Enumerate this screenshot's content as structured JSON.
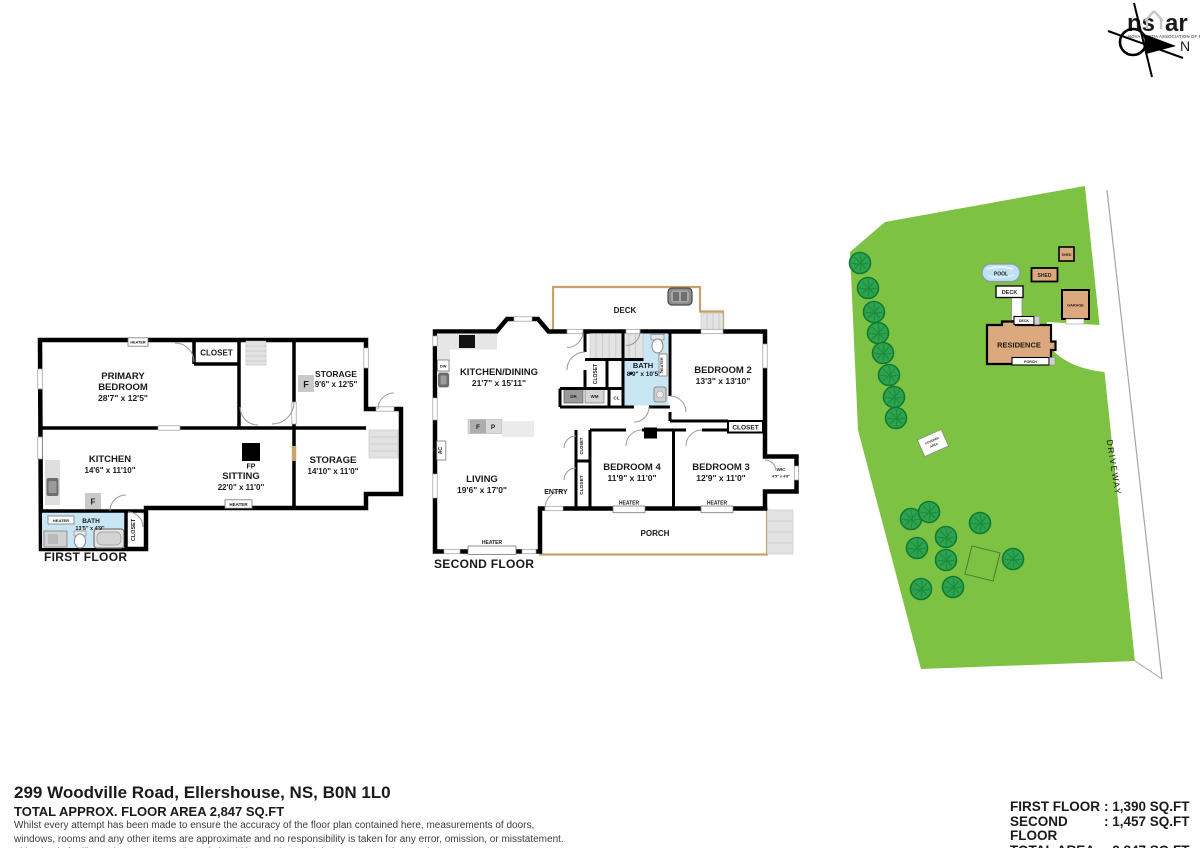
{
  "branding": {
    "logo_ns": "ns",
    "logo_ar": "ar",
    "logo_sub": "NOVA SCOTIA ASSOCIATION OF REALTORS",
    "north": "N"
  },
  "first_floor": {
    "title": "FIRST FLOOR",
    "rooms": {
      "primary_bedroom": {
        "line1": "PRIMARY",
        "line2": "BEDROOM",
        "dims": "28'7\" x 12'5\""
      },
      "storage1": {
        "name": "STORAGE",
        "dims": "9'6\" x 12'5\""
      },
      "kitchen": {
        "name": "KITCHEN",
        "dims": "14'6\" x 11'10\""
      },
      "sitting": {
        "name": "SITTING",
        "dims": "22'0\" x 11'0\""
      },
      "storage2": {
        "name": "STORAGE",
        "dims": "14'10\" x 11'0\""
      },
      "bath": {
        "name": "BATH",
        "dims": "13'5\" x 4'9\""
      }
    },
    "labels": {
      "closet": "CLOSET",
      "heater": "HEATER",
      "fp": "FP",
      "f": "F"
    }
  },
  "second_floor": {
    "title": "SECOND FLOOR",
    "rooms": {
      "kitchen_dining": {
        "name": "KITCHEN/DINING",
        "dims": "21'7\" x 15'11\""
      },
      "bath": {
        "name": "BATH",
        "dims": "8'9\" x 10'5\""
      },
      "bedroom2": {
        "name": "BEDROOM 2",
        "dims": "13'3\" x 13'10\""
      },
      "bedroom3": {
        "name": "BEDROOM 3",
        "dims": "12'9\" x 11'0\""
      },
      "bedroom4": {
        "name": "BEDROOM 4",
        "dims": "11'9\" x 11'0\""
      },
      "living": {
        "name": "LIVING",
        "dims": "19'6\" x 17'0\""
      },
      "wic": {
        "name": "WIC",
        "dims": "4'5\" x 4'8\""
      }
    },
    "labels": {
      "deck": "DECK",
      "porch": "PORCH",
      "entry": "ENTRY",
      "closet": "CLOSET",
      "heater": "HEATER",
      "dw": "DW",
      "dr": "DR",
      "wm": "WM",
      "cl": "CL",
      "f": "F",
      "p": "P",
      "ac": "AC"
    }
  },
  "site_plan": {
    "labels": {
      "residence": "RESIDENCE",
      "garage": "GARAGE",
      "shed": "SHED",
      "pool": "POOL",
      "deck": "DECK",
      "porch": "PORCH",
      "driveway": "DRIVEWAY",
      "covered1": "COVERED",
      "covered2": "AREA"
    },
    "colors": {
      "grass": "#7DC242",
      "tree_fill": "#2EA34E",
      "tree_stroke": "#0F7A36",
      "building": "#DCA97E",
      "pool": "#BFE1F5",
      "deck_outline": "#C8A06A"
    }
  },
  "footer": {
    "address": "299 Woodville Road, Ellershouse, NS, B0N 1L0",
    "total_line": "TOTAL APPROX. FLOOR AREA 2,847 SQ.FT",
    "disclaimer": [
      "Whilst every attempt has been made to ensure the accuracy of the floor plan contained here, measurements of doors,",
      "windows, rooms and any other items are approximate and no responsibility is taken for any error, omission, or misstatement.",
      "This plan is for illustrative purposes only and should be used as such by any prospective purchaser."
    ]
  },
  "area_summary": {
    "rows": [
      {
        "label": "FIRST FLOOR",
        "value": ": 1,390 SQ.FT"
      },
      {
        "label": "SECOND FLOOR",
        "value": ": 1,457 SQ.FT"
      },
      {
        "label": "TOTAL AREA",
        "value": ": 2,847 SQ.FT"
      }
    ]
  }
}
